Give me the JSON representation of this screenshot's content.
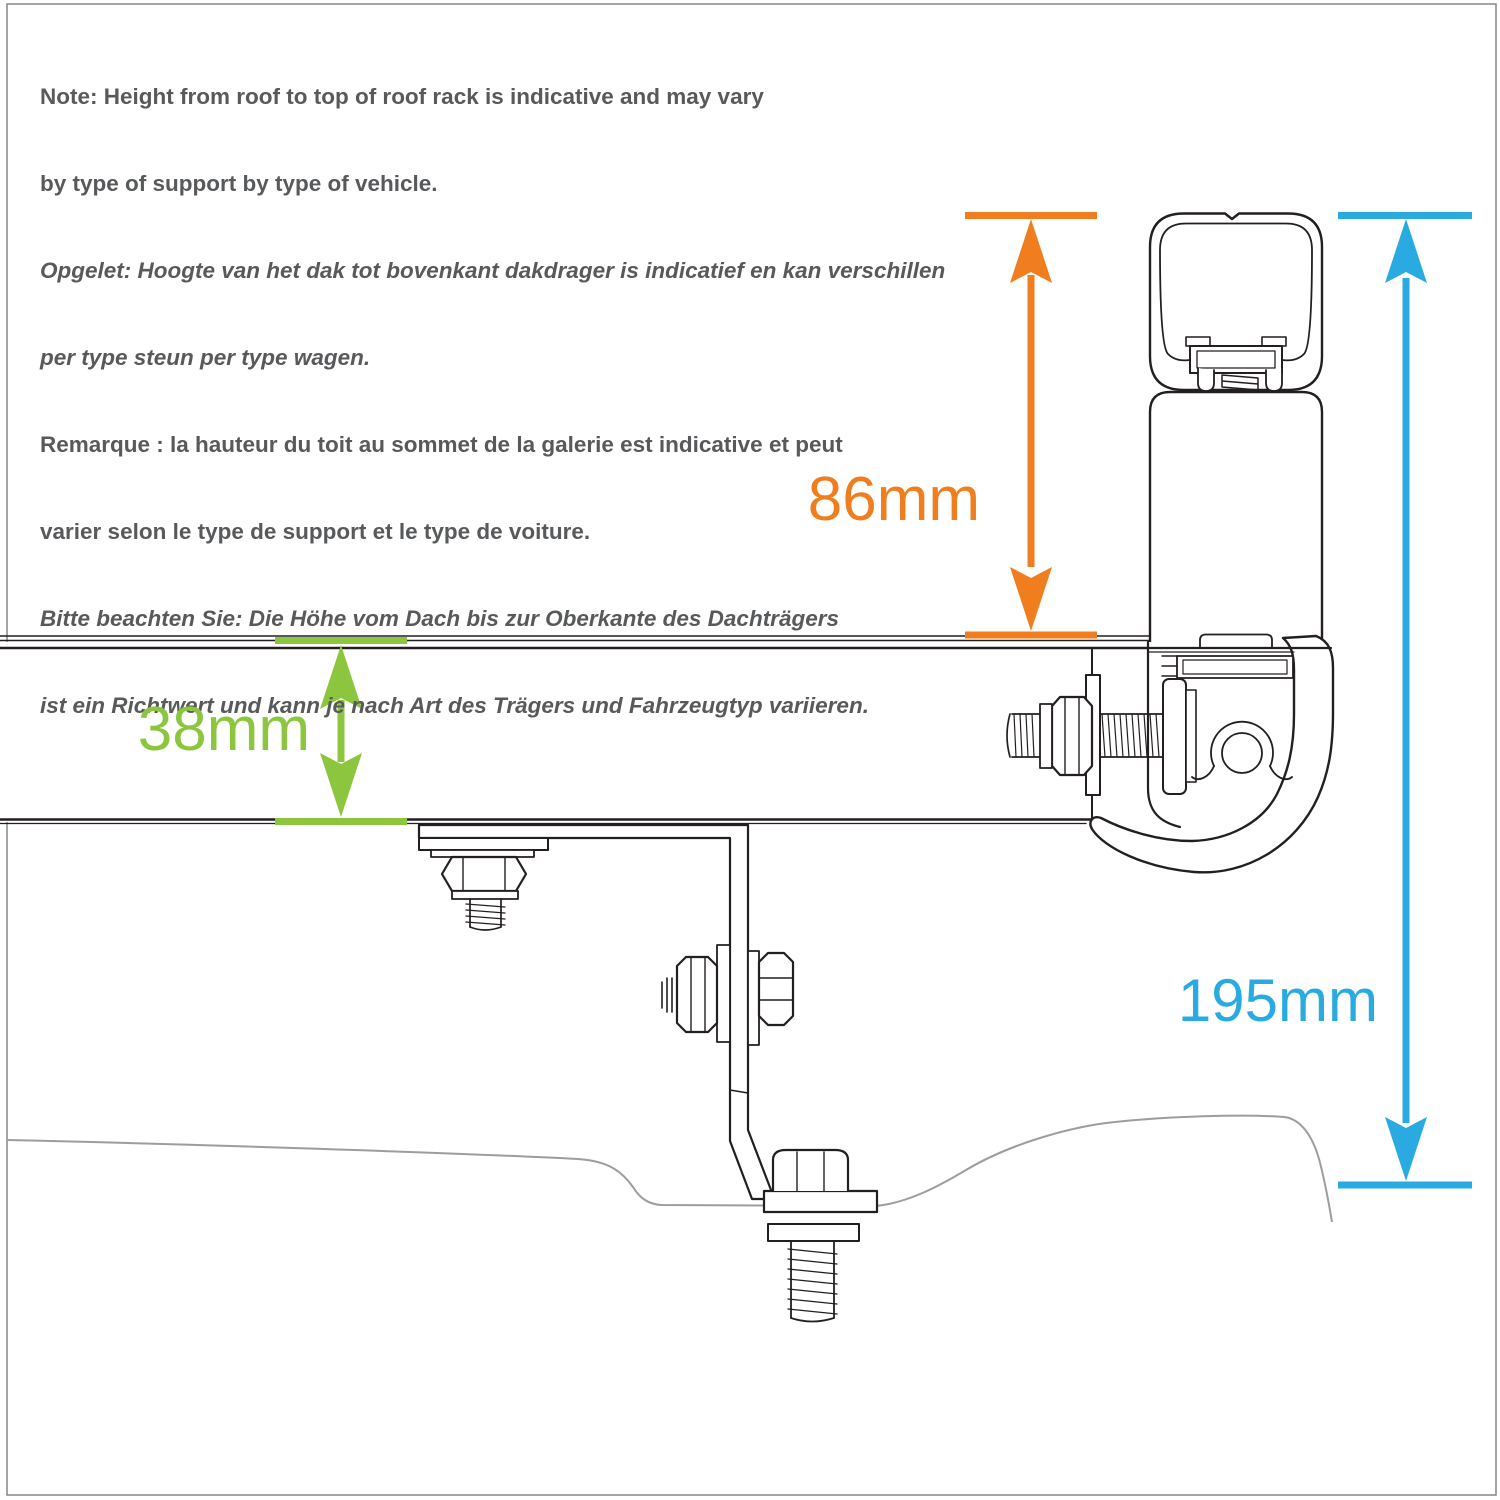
{
  "title": "Roof rack height diagram",
  "colors": {
    "orange": "#F07D1E",
    "green": "#8CC63F",
    "blue": "#29ABE2",
    "line": "#231F20",
    "roofline": "#9B9DA0",
    "frame": "#85878A",
    "text": "#58595B",
    "white": "#FFFFFF"
  },
  "note": {
    "lines": [
      {
        "text": "Note: Height from roof to top of roof rack is indicative and may vary",
        "style": "normal"
      },
      {
        "text": "by type of support by type of vehicle.",
        "style": "normal"
      },
      {
        "text": "Opgelet: Hoogte van het dak tot bovenkant dakdrager is indicatief en kan verschillen",
        "style": "italic"
      },
      {
        "text": "per type steun per type wagen.",
        "style": "italic"
      },
      {
        "text": "Remarque : la hauteur du toit au sommet de la galerie est indicative et peut",
        "style": "normal"
      },
      {
        "text": "varier selon le type de support et le type de voiture.",
        "style": "normal"
      },
      {
        "text": "Bitte beachten Sie: Die Höhe vom Dach bis zur Oberkante des Dachträgers",
        "style": "italic"
      },
      {
        "text": "ist ein Richtwert und kann je nach Art des Trägers und Fahrzeugtyp variieren.",
        "style": "italic"
      }
    ]
  },
  "dimensions": {
    "roof_to_rack_top": {
      "label": "86mm",
      "color": "#F07D1E"
    },
    "bar_thickness": {
      "label": "38mm",
      "color": "#8CC63F"
    },
    "total_height": {
      "label": "195mm",
      "color": "#29ABE2"
    }
  }
}
